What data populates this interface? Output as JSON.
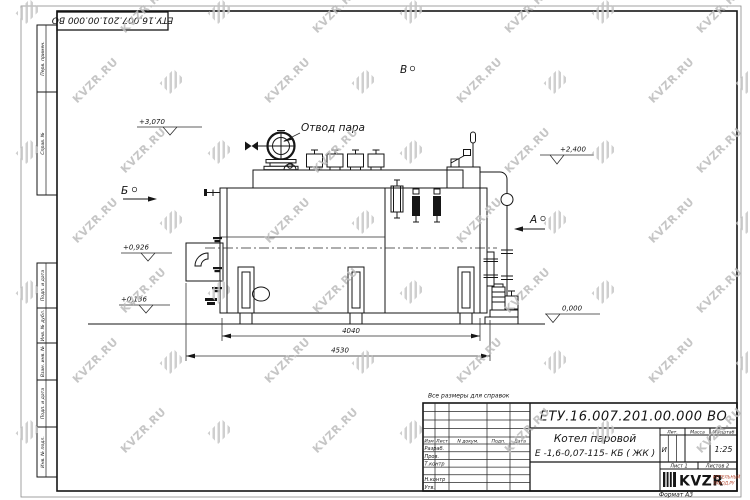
{
  "watermark": {
    "text": "KVZR.RU"
  },
  "doc_number": "ЕТУ.16.007.201.00.000  ВО",
  "note": "Все размеры для справок",
  "margin_labels": {
    "perv_primen": "Перв. примен.",
    "sprav_no": "Справ. №",
    "podp_data_1": "Подп. и дата",
    "inv_no_dubl": "Инв. № дубл.",
    "vzam_inv_no": "Взам. инв. №",
    "podp_data_2": "Подп. и дата",
    "inv_no_podl": "Инв. № подл."
  },
  "drawing": {
    "labels": {
      "steam_outlet": "Отвод пара",
      "view_b": "Б",
      "view_a": "А",
      "view_v": "В"
    },
    "elevations": {
      "e1": "+3,070",
      "e2": "+2,400",
      "e3": "+0,926",
      "e4": "+0,136",
      "e5": "0,000"
    },
    "dimensions": {
      "d1": "4040",
      "d2": "4530"
    }
  },
  "title_block": {
    "name_line1": "Котел паровой",
    "name_line2": "Е -1,6-0,07-115- КБ ( ЖК )",
    "col_izm": "Изм",
    "col_list": "Лист",
    "col_ndoc": "N докум.",
    "col_podp": "Подп.",
    "col_data": "Дата",
    "row_razrab": "Разраб.",
    "row_prov": "Пров.",
    "row_tkontr": "Т.контр",
    "row_nkontr": "Н.контр",
    "row_utv": "Утв.",
    "lit_header": "Лит.",
    "massa_header": "Масса",
    "masshtab_header": "Масштаб",
    "lit_value": "И",
    "scale_value": "1:25",
    "sheet": "Лист 1",
    "sheets": "Листов 2",
    "logo_text": "KVZR",
    "logo_sub1": "КОТЕЛЬНЫЙ",
    "logo_sub2": "ЗАВОД.РУ",
    "format": "Формат А3"
  }
}
